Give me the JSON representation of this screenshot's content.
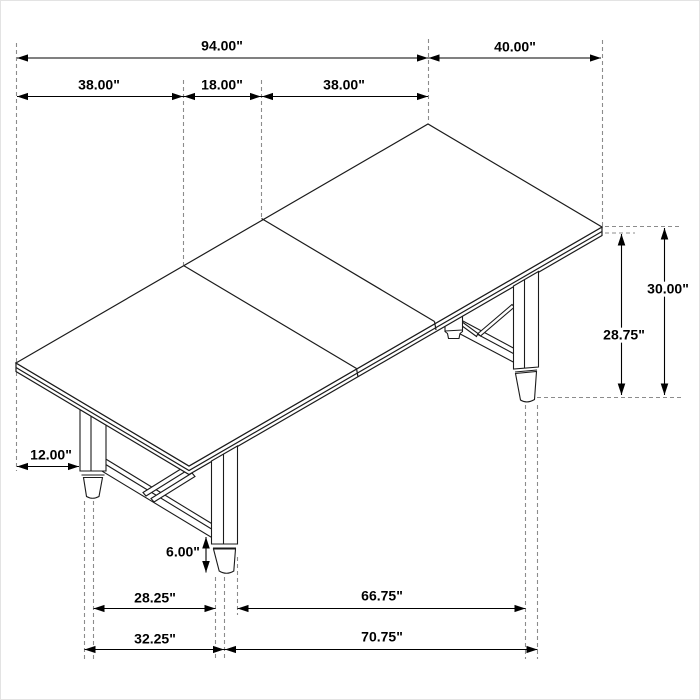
{
  "colors": {
    "background": "#ffffff",
    "drawing_line": "#1b1b1b",
    "dimension_line": "#000000",
    "extension_dash": "#8c8c8c"
  },
  "dimensions": {
    "length_total": {
      "label": "94.00\"",
      "value": 94.0
    },
    "section_left": {
      "label": "38.00\"",
      "value": 38.0
    },
    "section_middle": {
      "label": "18.00\"",
      "value": 18.0
    },
    "section_right": {
      "label": "38.00\"",
      "value": 38.0
    },
    "width": {
      "label": "40.00\"",
      "value": 40.0
    },
    "height_total": {
      "label": "30.00\"",
      "value": 30.0
    },
    "height_to_underside": {
      "label": "28.75\"",
      "value": 28.75
    },
    "top_overhang": {
      "label": "12.00\"",
      "value": 12.0
    },
    "foot_height": {
      "label": "6.00\"",
      "value": 6.0
    },
    "feet_span_inner": {
      "label": "28.25\"",
      "value": 28.25
    },
    "feet_span_outer": {
      "label": "32.25\"",
      "value": 32.25
    },
    "leg_spacing_inner": {
      "label": "66.75\"",
      "value": 66.75
    },
    "leg_spacing_outer": {
      "label": "70.75\"",
      "value": 70.75
    }
  }
}
